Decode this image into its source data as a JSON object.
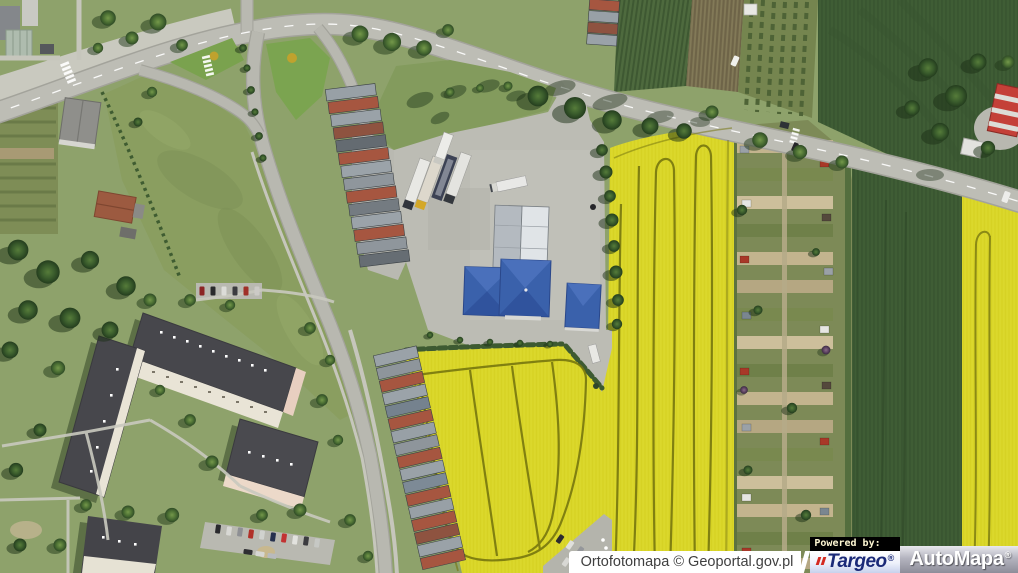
{
  "window": {
    "width": 1018,
    "height": 573
  },
  "map": {
    "colors": {
      "rapeseed_yellow": "#dbd82c",
      "dark_field_green": "#3f5d35",
      "grass_green": "#8ea26b",
      "road_gray": "#bdbdb5",
      "roof_blue": "#3a61ab",
      "roof_rust": "#a65640",
      "roof_dark_gray": "#47474c"
    }
  },
  "attribution": {
    "source_label": "Ortofotomapa © Geoportal.gov.pl"
  },
  "powered_by": {
    "label": "Powered by:"
  },
  "logos": {
    "targeo": {
      "text": "Targeo",
      "registered_mark": "®",
      "brand_color": "#1b2a78",
      "accent_color": "#d42a20"
    },
    "automapa": {
      "text": "AutoMapa",
      "registered_mark": "®",
      "text_color": "#ffffff"
    }
  }
}
